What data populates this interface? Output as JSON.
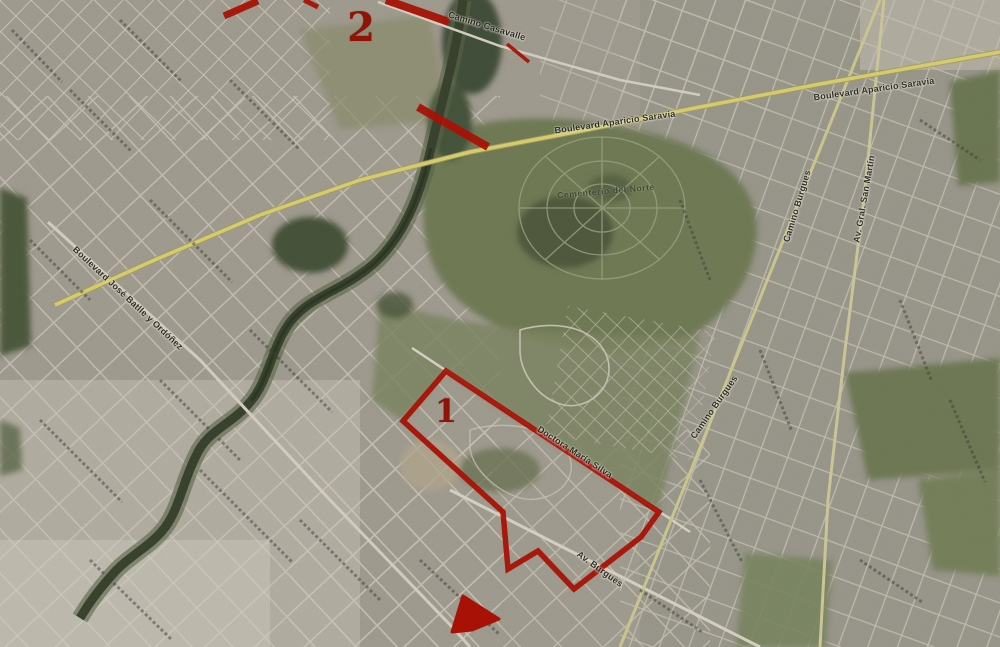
{
  "street_labels": [
    {
      "text": "Camino Casavalle",
      "x": 487,
      "y": 26,
      "rot": 17
    },
    {
      "text": "Boulevard Aparicio Saravia",
      "x": 615,
      "y": 122,
      "rot": -8
    },
    {
      "text": "Boulevard Aparicio Saravia",
      "x": 874,
      "y": 89,
      "rot": -8
    },
    {
      "text": "Boulevard José Batlle y Ordóñez",
      "x": 128,
      "y": 298,
      "rot": 43
    },
    {
      "text": "Doctora María Silva",
      "x": 575,
      "y": 452,
      "rot": 33
    },
    {
      "text": "Av. Burgues",
      "x": 600,
      "y": 569,
      "rot": 36
    },
    {
      "text": "Camino Burgues",
      "x": 714,
      "y": 407,
      "rot": -55
    },
    {
      "text": "Camino Burgues",
      "x": 797,
      "y": 206,
      "rot": -73
    },
    {
      "text": "Av. Gral. San Martín",
      "x": 864,
      "y": 199,
      "rot": -80
    }
  ],
  "place_labels": [
    {
      "text": "Cementerio del Norte",
      "x": 606,
      "y": 191,
      "rot": -5
    }
  ],
  "annotations": {
    "accent_color": "#a81206",
    "markers": [
      {
        "label": "2",
        "x": 361,
        "y": 28,
        "size": 40
      },
      {
        "label": "1",
        "x": 446,
        "y": 411,
        "size": 32
      }
    ],
    "segments": [
      {
        "points": [
          [
            224,
            16
          ],
          [
            258,
            1
          ]
        ],
        "w": 7
      },
      {
        "points": [
          [
            304,
            0
          ],
          [
            318,
            7
          ]
        ],
        "w": 5
      },
      {
        "points": [
          [
            386,
            0
          ],
          [
            449,
            22
          ]
        ],
        "w": 8
      },
      {
        "points": [
          [
            418,
            107
          ],
          [
            488,
            147
          ]
        ],
        "w": 8
      },
      {
        "points": [
          [
            507,
            44
          ],
          [
            529,
            62
          ]
        ],
        "w": 3.5
      }
    ],
    "parcel_outline": {
      "points": [
        [
          403,
          421
        ],
        [
          446,
          371
        ],
        [
          659,
          512
        ],
        [
          641,
          537
        ],
        [
          574,
          589
        ],
        [
          538,
          551
        ],
        [
          508,
          569
        ],
        [
          503,
          512
        ]
      ],
      "w": 5.5
    },
    "arrow": {
      "points": [
        [
          452,
          632
        ],
        [
          463,
          596
        ],
        [
          499,
          619
        ],
        [
          472,
          630
        ]
      ]
    }
  }
}
